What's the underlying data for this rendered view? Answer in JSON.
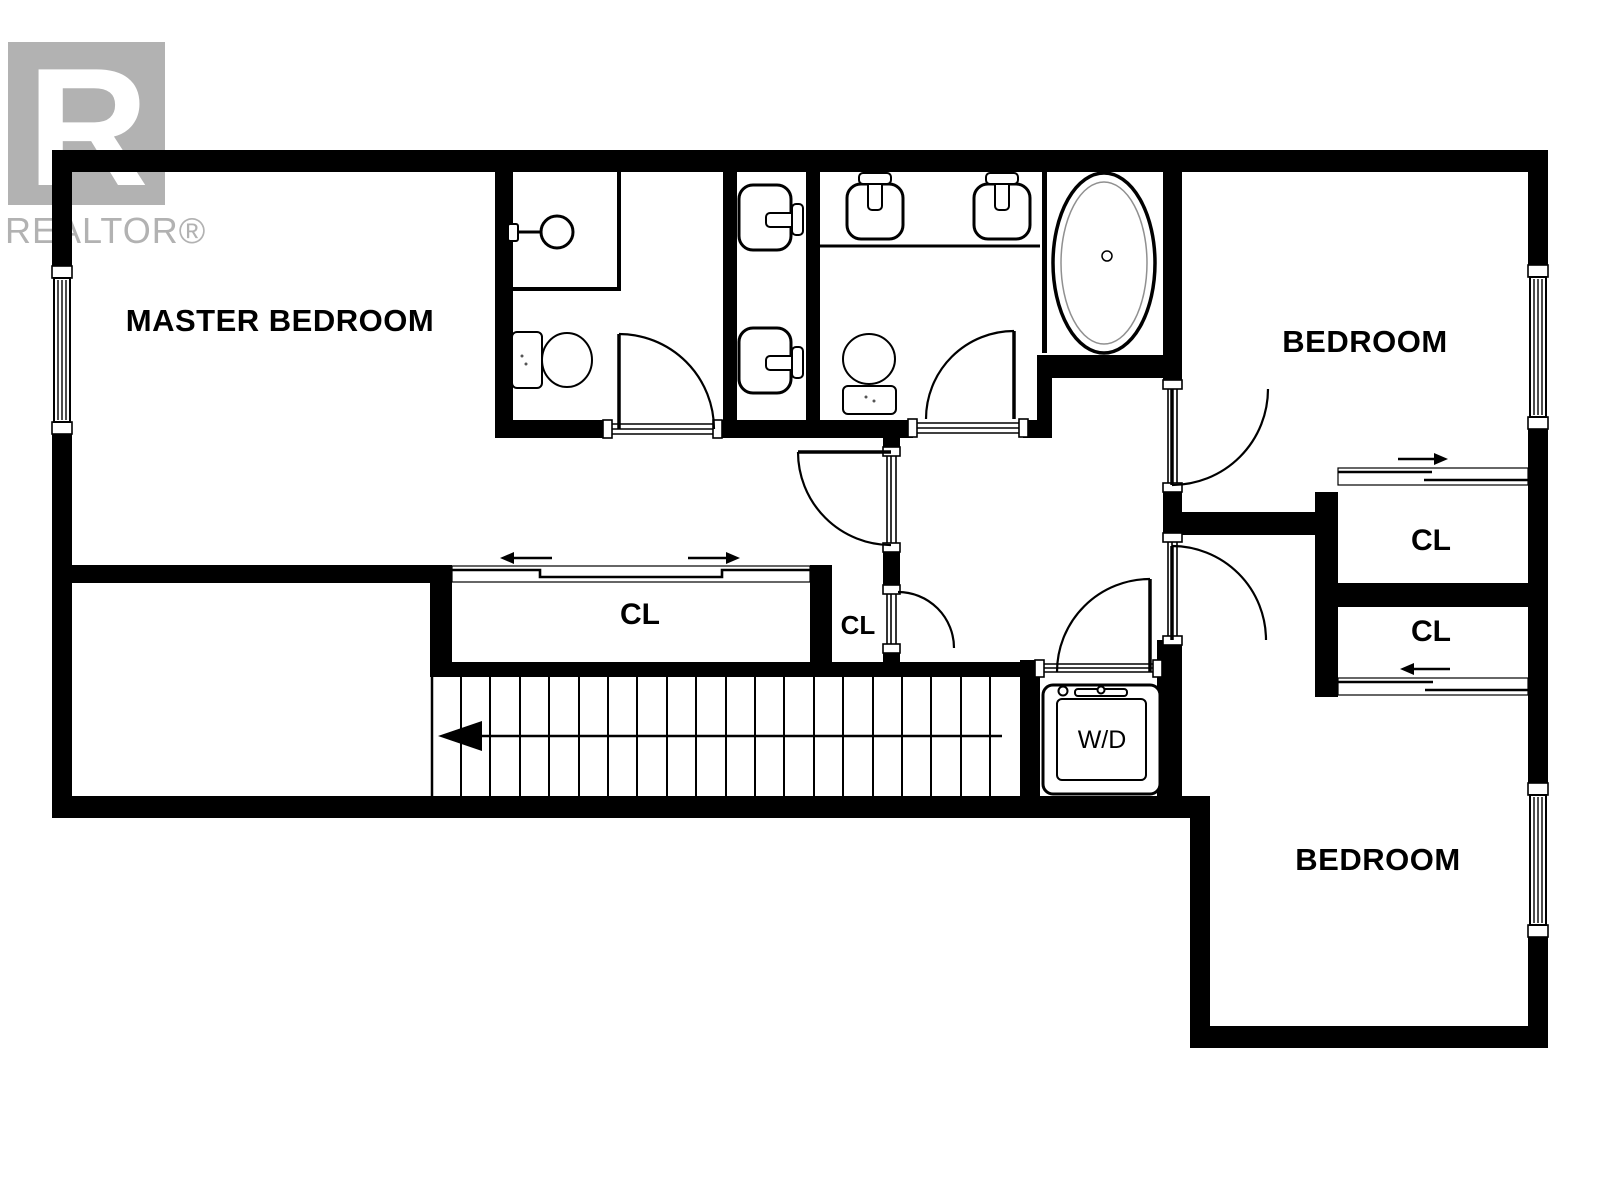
{
  "logo": {
    "letter": "R",
    "wordmark": "REALTOR®",
    "color": "#b2b2b2"
  },
  "colors": {
    "wall": "#000000",
    "background": "#ffffff",
    "tub_inner_line": "#909090"
  },
  "rooms": {
    "master_bedroom": {
      "label": "MASTER BEDROOM"
    },
    "bedroom_top_right": {
      "label": "BEDROOM"
    },
    "bedroom_bottom_right": {
      "label": "BEDROOM"
    },
    "closet_hall_large": {
      "label": "CL"
    },
    "closet_hall_small": {
      "label": "CL"
    },
    "closet_right_top": {
      "label": "CL"
    },
    "closet_right_bottom": {
      "label": "CL"
    },
    "laundry_closet": {
      "label": "W/D"
    }
  },
  "fixtures": {
    "bathroom_1": [
      "shower",
      "toilet",
      "sink",
      "sink"
    ],
    "bathroom_2": [
      "sink",
      "sink",
      "toilet",
      "bathtub"
    ],
    "laundry": [
      "washer-dryer"
    ]
  },
  "stairs": {
    "direction": "left",
    "tread_count": 19
  }
}
